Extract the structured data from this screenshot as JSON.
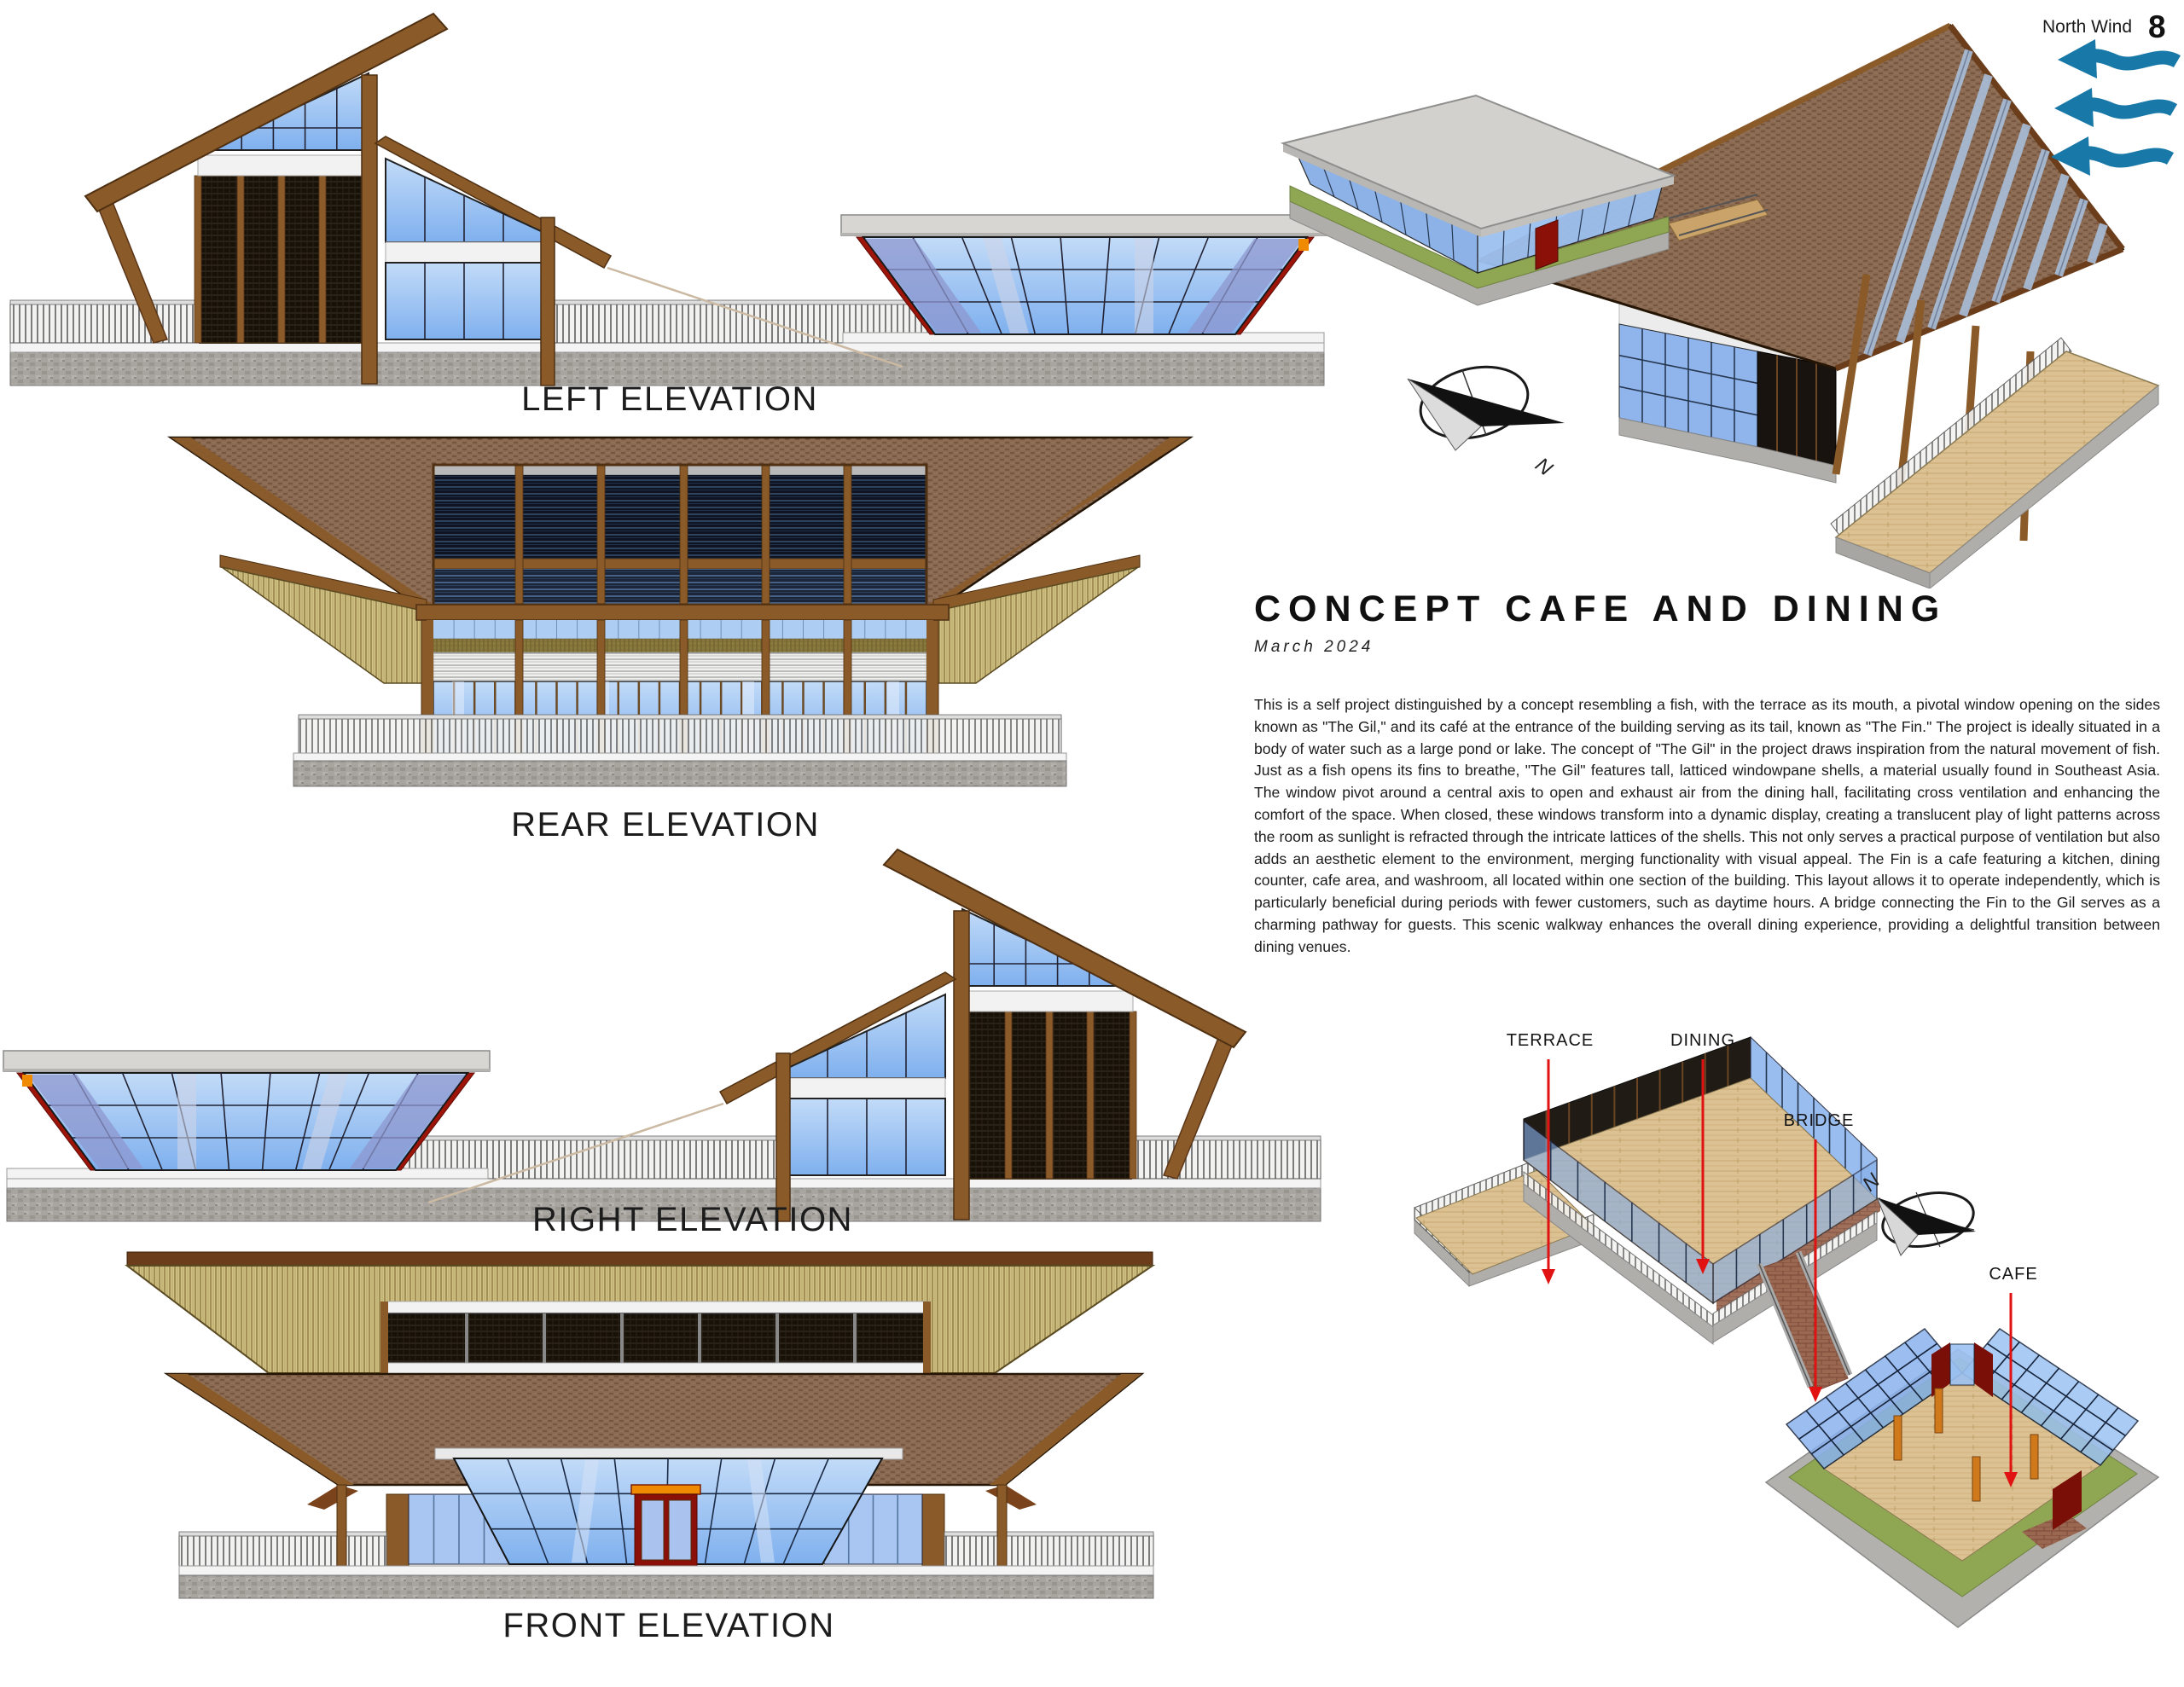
{
  "page": {
    "number": "8"
  },
  "wind": {
    "label": "North Wind",
    "icon": "north-wind-waves-icon",
    "color": "#1878a8"
  },
  "elevations": {
    "left": {
      "label": "LEFT ELEVATION"
    },
    "rear": {
      "label": "REAR ELEVATION"
    },
    "right": {
      "label": "RIGHT ELEVATION"
    },
    "front": {
      "label": "FRONT ELEVATION"
    }
  },
  "concept": {
    "title": "CONCEPT CAFE AND DINING",
    "date": "March 2024",
    "body": "This is a self project distinguished by a concept resembling a fish, with the terrace as its mouth, a pivotal window opening on the sides known as \"The Gil,\" and its café at the entrance of the building serving as its tail, known as \"The Fin.\"  The project is ideally situated in a body of water such as a large pond or lake. The concept of \"The Gil\" in the project draws inspiration from the natural movement of fish. Just as a fish opens its fins to breathe, \"The Gil\" features tall, latticed windowpane shells, a material usually found in Southeast Asia. The window pivot around a central axis to open and exhaust air from the dining hall, facilitating cross ventilation and enhancing the comfort of the space. When closed, these windows transform into a dynamic display, creating a translucent play of light patterns across the room as sunlight is refracted through the intricate lattices of the shells. This not only serves a practical purpose of ventilation but also adds an aesthetic element to the environment, merging functionality with visual appeal.  The Fin is a cafe featuring a kitchen, dining counter, cafe area, and washroom, all located within one section of the building. This layout allows it to operate independently, which is particularly beneficial during periods with fewer customers, such as daytime hours. A bridge connecting the Fin to the Gil serves as a charming pathway for guests. This scenic walkway enhances the overall dining experience, providing a delightful transition between dining venues."
  },
  "plan": {
    "labels": {
      "terrace": "TERRACE",
      "dining": "DINING",
      "bridge": "BRIDGE",
      "cafe": "CAFE"
    },
    "compass_letter": "N",
    "arrow_color": "#e01212"
  },
  "iso": {
    "compass_letter": "N"
  },
  "colors": {
    "wind_blue": "#1878a8",
    "label_red": "#e01212",
    "roof_brown": "#8a6a52",
    "wood_beam": "#8a5a28",
    "glass_blue": "#84b2ef",
    "lattice_dark": "#171108",
    "straw_tan": "#cfc083",
    "stone_gray": "#a8a5a1",
    "lawn_green": "#8fa653",
    "deck_wood": "#dcc192",
    "accent_red": "#9e1409",
    "accent_orange": "#f08a00"
  }
}
